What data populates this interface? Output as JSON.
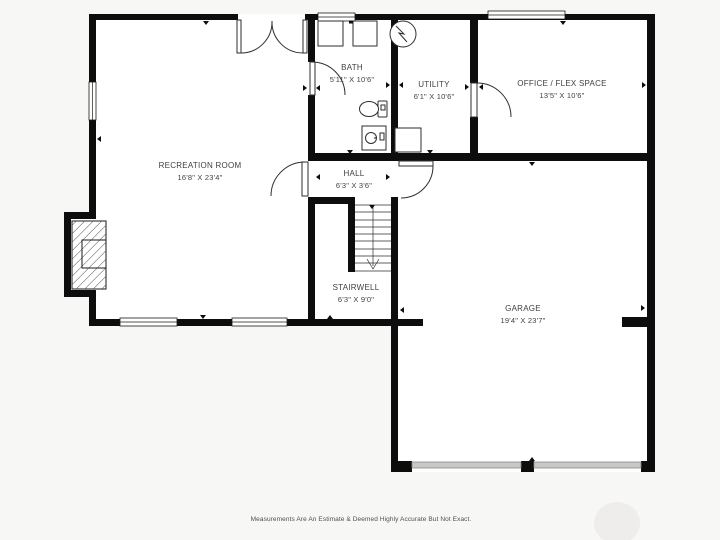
{
  "rooms": [
    {
      "id": "recreation-room",
      "name": "RECREATION ROOM",
      "dims": "16'8\" X 23'4\""
    },
    {
      "id": "bath",
      "name": "BATH",
      "dims": "5'11\" X 10'6\""
    },
    {
      "id": "utility",
      "name": "UTILITY",
      "dims": "6'1\" X 10'6\""
    },
    {
      "id": "office-flex-space",
      "name": "OFFICE / FLEX SPACE",
      "dims": "13'5\" X 10'6\""
    },
    {
      "id": "hall",
      "name": "HALL",
      "dims": "6'3\" X 3'6\""
    },
    {
      "id": "stairwell",
      "name": "STAIRWELL",
      "dims": "6'3\" X 9'0\""
    },
    {
      "id": "garage",
      "name": "GARAGE",
      "dims": "19'4\" X 23'7\""
    }
  ],
  "footer": {
    "disclaimer": "Measurements Are An Estimate & Deemed Highly Accurate But Not Exact."
  },
  "colors": {
    "background": "#f7f7f5",
    "floor": "#ffffff",
    "wall": "#0d0d0d",
    "line": "#2e2e2e",
    "label_text": "#3f3f3f",
    "disclaimer_text": "#4f4f4f",
    "garage_door_fill": "#c8c8c8",
    "garage_door_edge": "#8a8a8a",
    "watermark": "#e9e6e1"
  }
}
